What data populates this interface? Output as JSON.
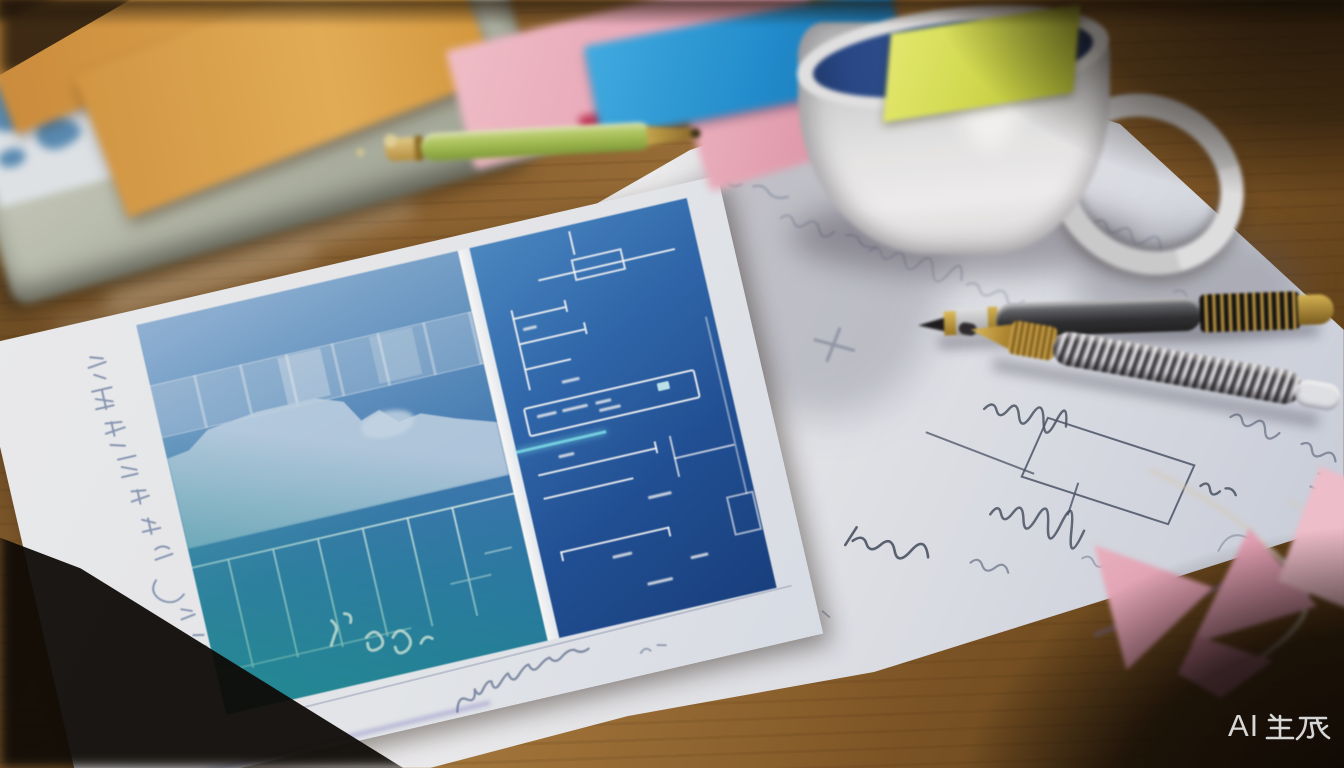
{
  "image_type": "photograph",
  "scene_label": "Blueprint wireframe printout on a wooden desk with mug, pens and sticky notes",
  "watermark": {
    "text": "AI生成",
    "latin_part": "AI",
    "color": "#e8e8e8"
  },
  "legible_text_other_than_watermark": false,
  "objects": [
    "wood-desk",
    "laptop",
    "map-print-paper",
    "orange-cards",
    "green-pen",
    "pink-sticky-notes",
    "blue-sticky-note",
    "red-note-edge",
    "blueprint-sheet",
    "blueprint-print",
    "handwritten-scribbles",
    "right-notes-paper",
    "hand-drawn-box-sketch",
    "coffee-mug",
    "yellow-green-sticky-on-mug",
    "dark-ballpoint-pen",
    "silver-spiral-pen",
    "pink-paper-scraps",
    "string",
    "ai-watermark"
  ],
  "palette": {
    "wood_light": "#9c7038",
    "wood_dark": "#3a2410",
    "paper_white": "#f2f3f6",
    "blueprint_sky": "#8fb3d9",
    "blueprint_mid": "#2f6cae",
    "blueprint_deep": "#16418a",
    "blueprint_teal": "#1f8fa0",
    "silhouette_light": "#c2d6ea",
    "accent_cyan": "#72d4e8",
    "sticky_pink": "#eda9bd",
    "sticky_blue": "#1e8fd4",
    "red_edge": "#c43b5c",
    "card_orange": "#d79a45",
    "pen_green": "#a3bf52",
    "mug_white": "#e9eaec",
    "mug_interior_navy": "#24478a",
    "sticky_yellow_green": "#d6e050",
    "gold_metal": "#c8a345",
    "pink_scrap": "#ecaabf",
    "ink_handwriting": "#6d83a8"
  }
}
